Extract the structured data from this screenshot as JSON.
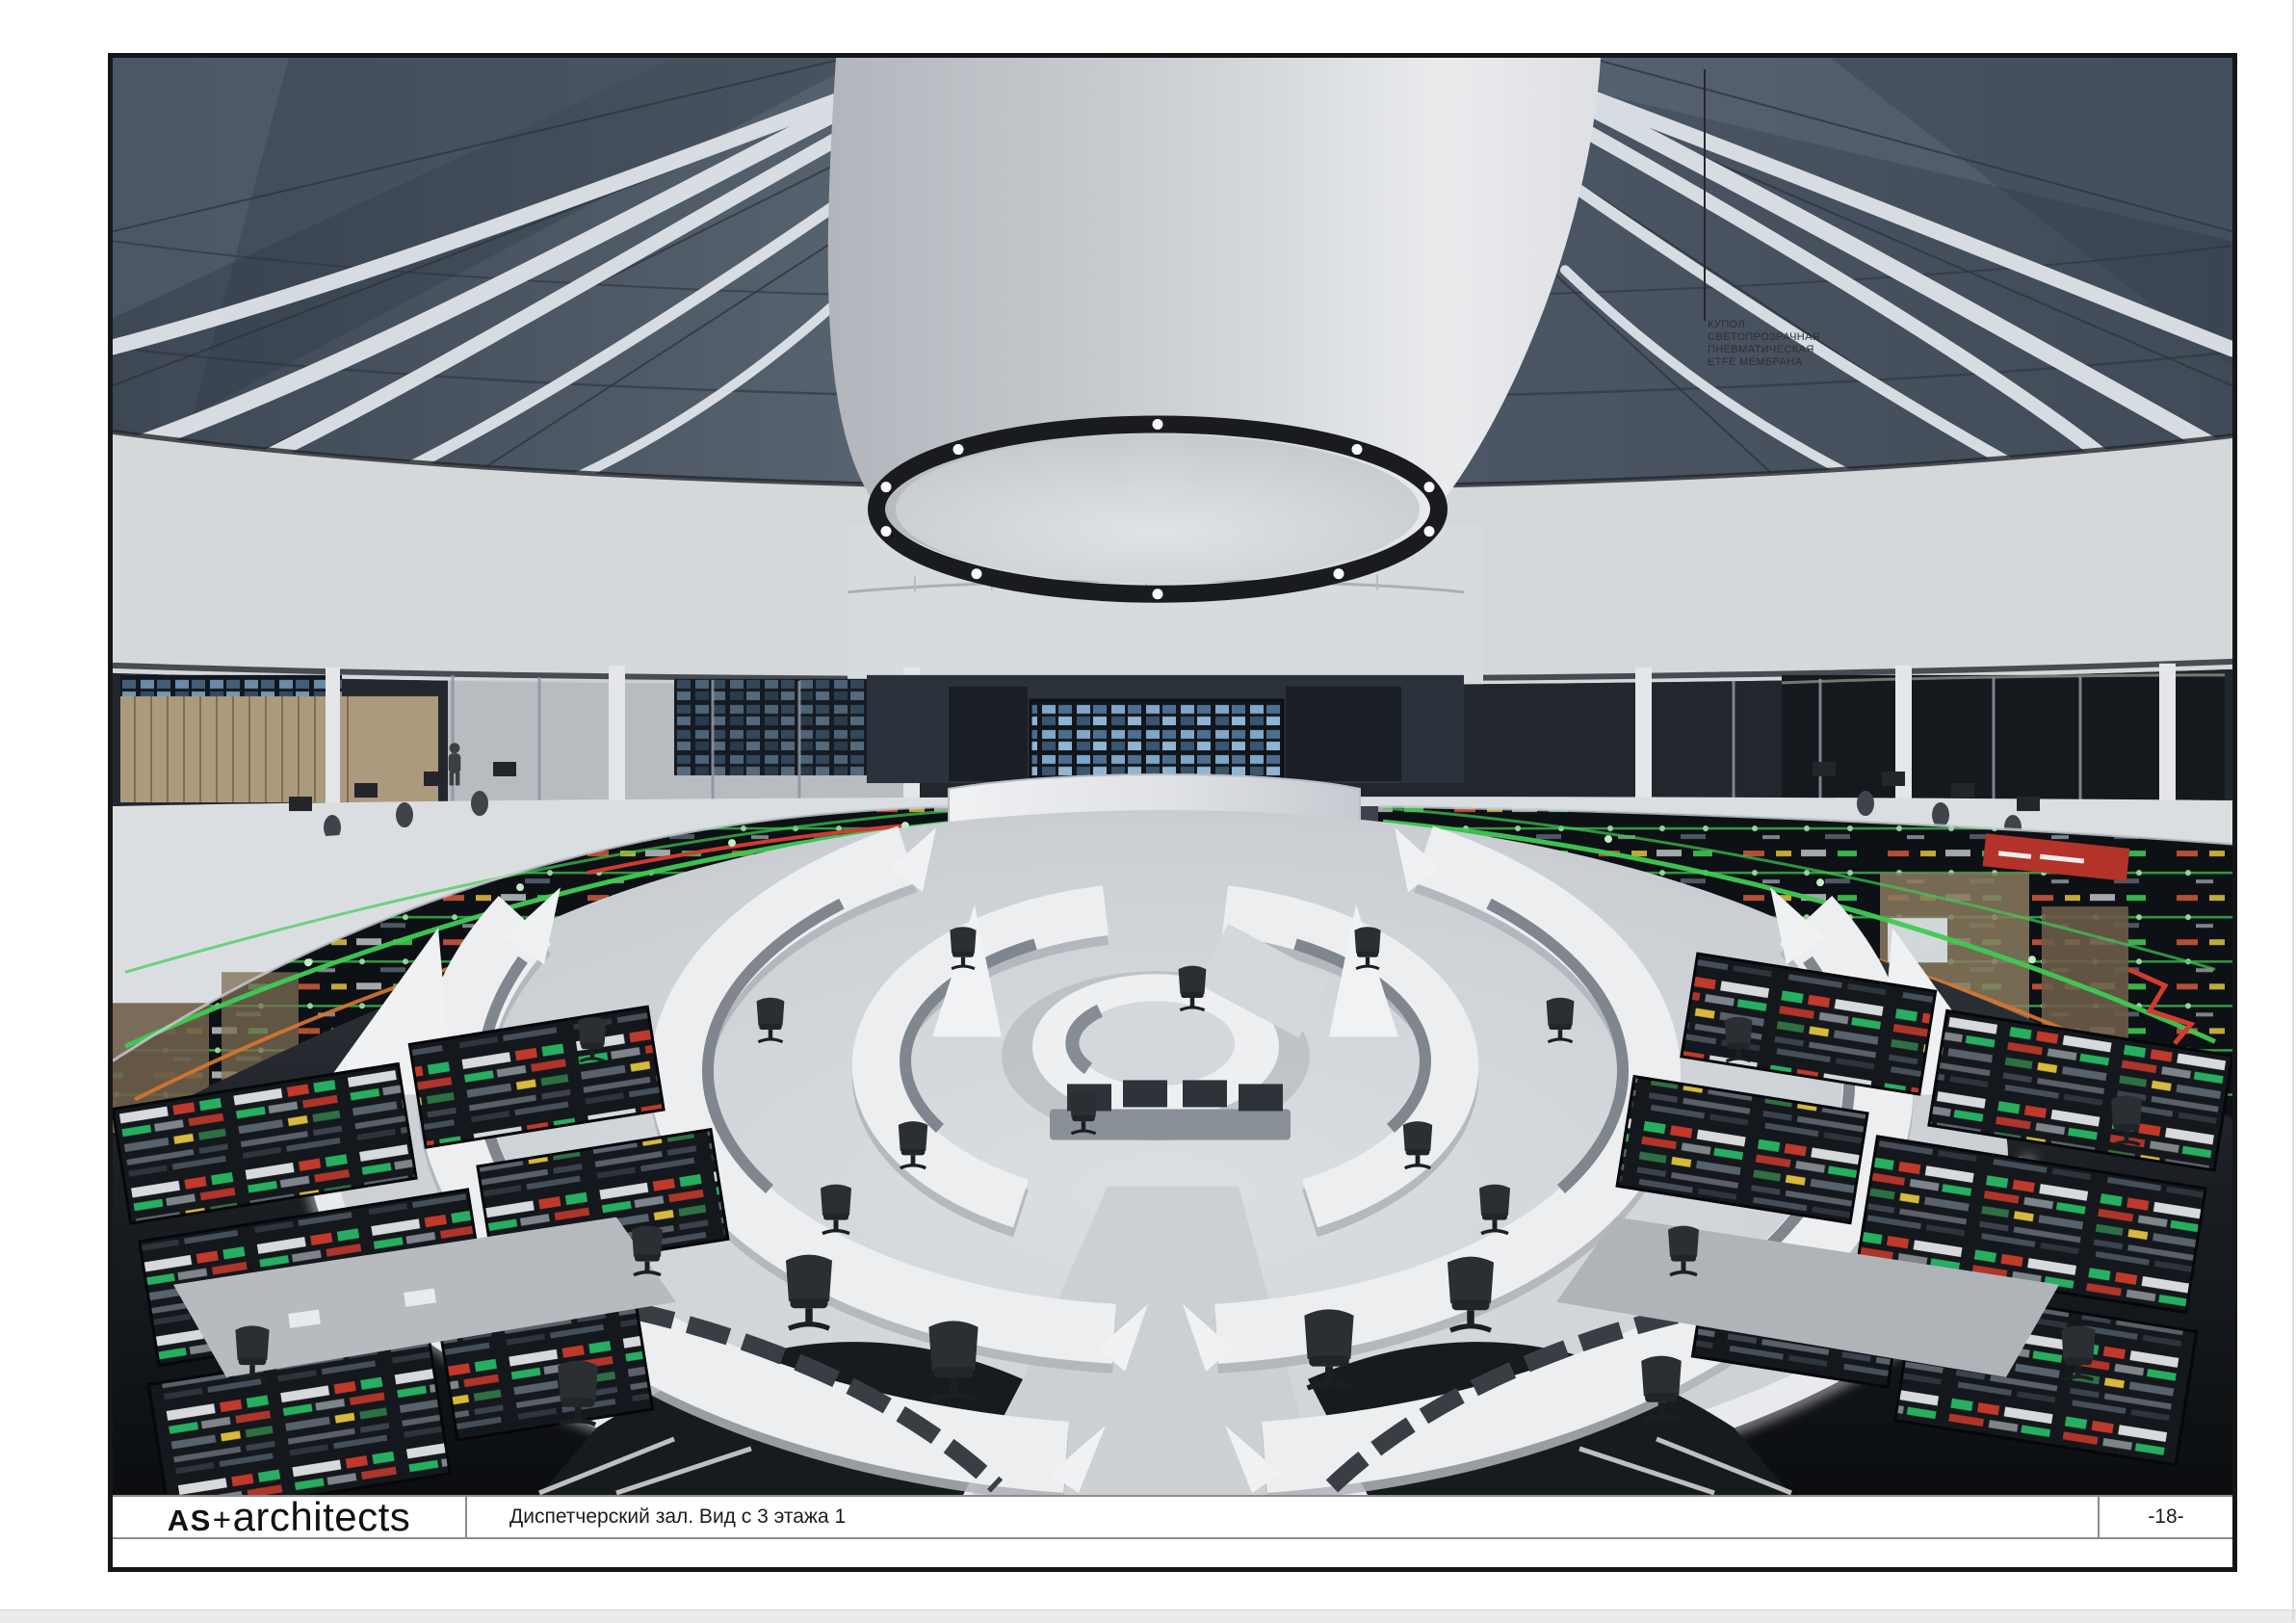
{
  "sheet": {
    "annotation": {
      "lines": [
        "КУПОЛ",
        "СВЕТОПРОЗРАЧНАЯ",
        "ПНЕВМАТИЧЕСКАЯ",
        "ETFE МЕМБРАНА"
      ]
    },
    "title_block": {
      "logo_bold": "AS",
      "logo_plus": "+",
      "logo_rest": "architects",
      "caption": "Диспетчерский зал. Вид с 3 этажа 1",
      "page_number": "-18-"
    },
    "colors": {
      "frame_border": "#161616",
      "dome_glass": "#4b5665",
      "membrane_white": "#d8dadd",
      "route_green": "#3fca54",
      "route_orange": "#d8772f",
      "alert_red": "#c43a2e",
      "floor_gray": "#ccd0d4",
      "console_dark": "#0d1014",
      "led_white": "#ffffff"
    }
  }
}
